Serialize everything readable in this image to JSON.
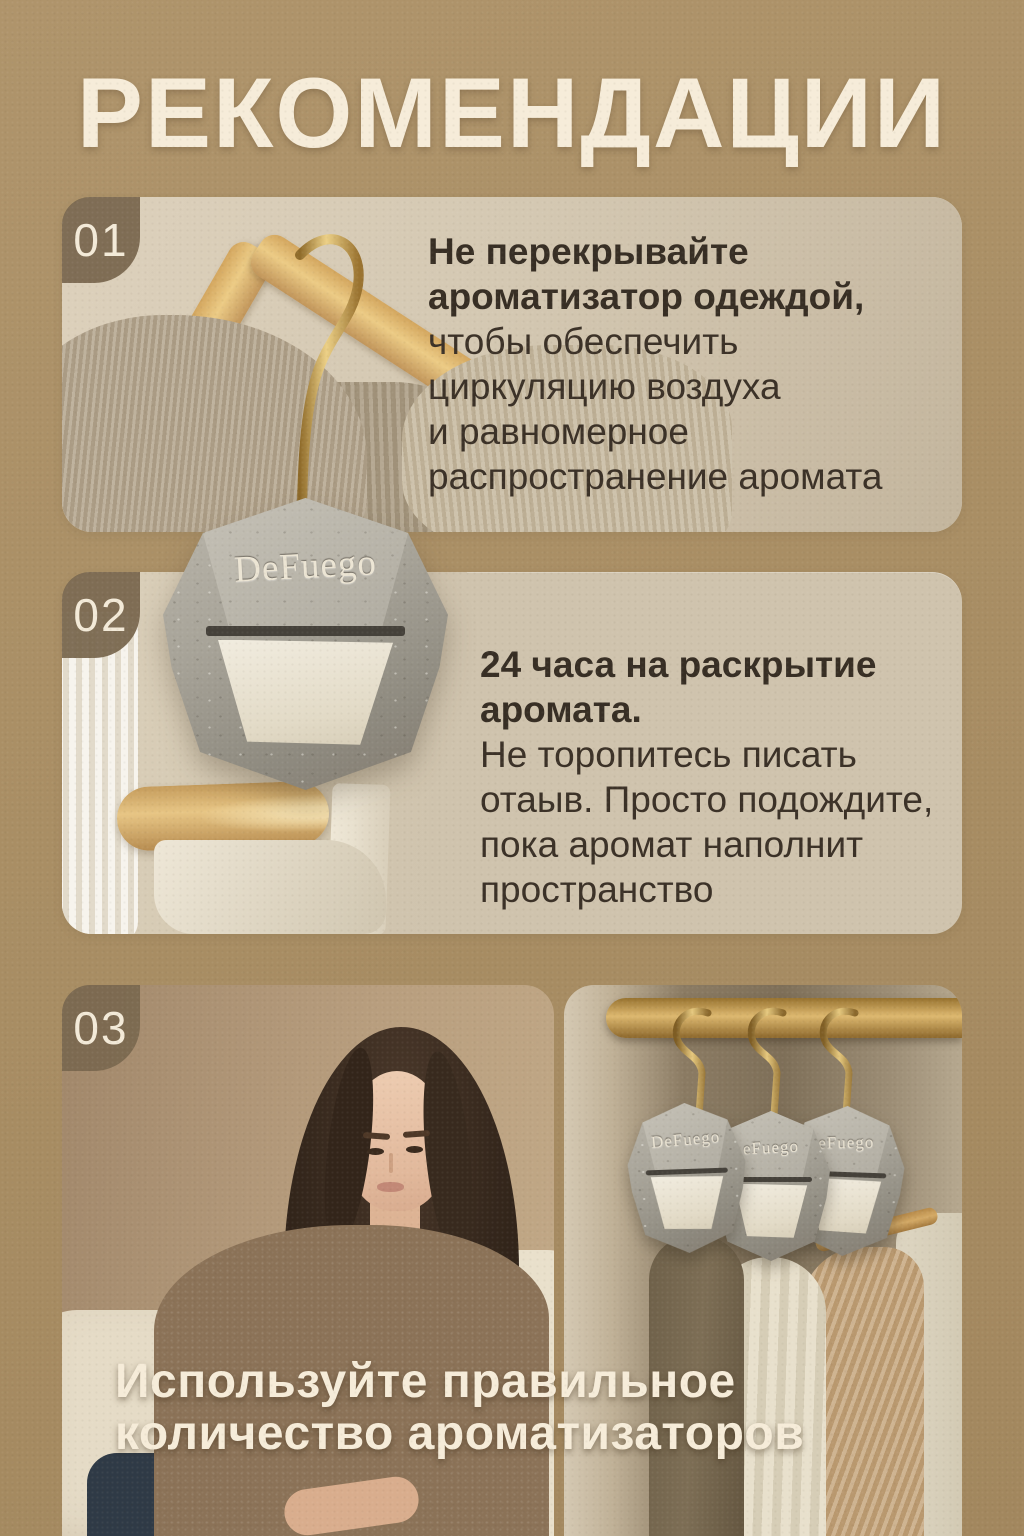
{
  "poster": {
    "title": "РЕКОМЕНДАЦИИ",
    "brand": "DeFuego"
  },
  "colors": {
    "background": "#a98e64",
    "card_background": "#cfc3ad",
    "badge_brown": "#7b6950",
    "cream_text": "#f6ecd9",
    "dark_text": "#3b3127",
    "gold": "#c9a050",
    "stone_grey": "#9b978c",
    "panel_cream": "#e9e3d3"
  },
  "sections": [
    {
      "number": "01",
      "heading_lines": [
        "Не перекрывайте",
        "ароматизатор одеждой,"
      ],
      "body_lines": [
        "чтобы обеспечить",
        "циркуляцию воздуха",
        "и равномерное",
        "распространение аромата"
      ]
    },
    {
      "number": "02",
      "heading_lines": [
        "24 часа на раскрытие",
        "аромата."
      ],
      "body_lines": [
        "Не торопитесь писать",
        "отаыв. Просто подождите,",
        "пока аромат наполнит",
        "пространство"
      ]
    },
    {
      "number": "03",
      "caption_lines": [
        "Используйте правильное",
        "количество ароматизаторов"
      ]
    }
  ],
  "product": {
    "label_main": "DeFuego",
    "label_hanging": [
      "DeFuego",
      "eFuego",
      "eFuego"
    ]
  }
}
